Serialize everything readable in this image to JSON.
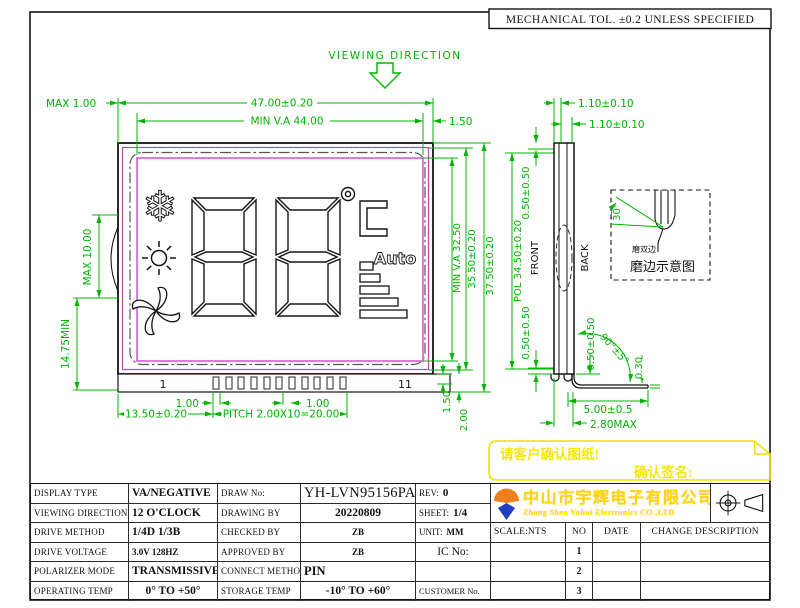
{
  "sheet": {
    "tolerance_note": "MECHANICAL TOL. ±0.2 UNLESS SPECIFIED"
  },
  "viewing": {
    "label": "VIEWING DIRECTION"
  },
  "front_view": {
    "pin_first": "1",
    "pin_last": "11",
    "lcd": {
      "auto_label": "Auto",
      "snow_glyph": "❄"
    },
    "dims": {
      "edge_max": "MAX 1.00",
      "width": "47.00±0.20",
      "va_width": "MIN V.A 44.00",
      "right_gap": "1.50",
      "left_max": "MAX 10.00",
      "left_min": "14.75MIN",
      "va_height": "MIN V.A 32.50",
      "mid_height": "35.50±0.20",
      "total_height": "37.50±0.20",
      "pol_height": "POL 34.50±0.20",
      "ledge_a": "1.50",
      "ledge_b": "2.00",
      "pin_offset": "13.50±0.20",
      "pitch": "PITCH 2.00X10=20.00",
      "pin_w_left": "1.00",
      "pin_w_right": "1.00"
    }
  },
  "side_view": {
    "front": "FRONT",
    "back": "BACK",
    "dims": {
      "glass_a": "1.10±0.10",
      "glass_b": "1.10±0.10",
      "step_top": "0.50±0.50",
      "step_bottom": "0.50±0.50",
      "step_right": "0.50±0.50",
      "bend": "90°±5°",
      "pin_t": "0.30",
      "pin_len": "5.00±0.5",
      "max_t": "2.80MAX"
    }
  },
  "detail": {
    "angle": "30°",
    "note": "磨双边",
    "caption": "磨边示意图"
  },
  "confirm": {
    "line1": "请客户确认图纸!",
    "line2": "确认签名:"
  },
  "company": {
    "cn": "中山市宇辉电子有限公司",
    "en": "Zhong Shen Yuhui Electronics CO.,LTD"
  },
  "title_table": {
    "rows": [
      {
        "l1": "DISPLAY TYPE",
        "v1": "VA/NEGATIVE",
        "l2": "DRAW No:",
        "v2": "YH-LVN95156PA",
        "l3": "REV:",
        "v3": "0"
      },
      {
        "l1": "VIEWING DIRECTION",
        "v1": "12 O'CLOCK",
        "l2": "DRAWING BY",
        "v2": "20220809",
        "l3": "SHEET:",
        "v3": "1/4"
      },
      {
        "l1": "DRIVE METHOD",
        "v1": "1/4D  1/3B",
        "l2": "CHECKED BY",
        "v2": "ZB",
        "l3": "UNIT:",
        "v3": "MM"
      },
      {
        "l1": "DRIVE VOLTAGE",
        "v1": "3.0V  128HZ",
        "l2": "APPROVED BY",
        "v2": "ZB",
        "l3": "IC No:",
        "v3": ""
      },
      {
        "l1": "POLARIZER MODE",
        "v1": "TRANSMISSIVE",
        "l2": "CONNECT METHOD",
        "v2": "PIN",
        "l3": "",
        "v3": ""
      },
      {
        "l1": "OPERATING TEMP",
        "v1": "0° TO +50°",
        "l2": "STORAGE TEMP",
        "v2": "-10° TO +60°",
        "l3": "CUSTOMER No.",
        "v3": ""
      }
    ]
  },
  "revision": {
    "scale": "SCALE:NTS",
    "no": "NO",
    "date": "DATE",
    "change": "CHANGE DESCRIPTION",
    "rows": [
      "1",
      "2",
      "3"
    ]
  }
}
